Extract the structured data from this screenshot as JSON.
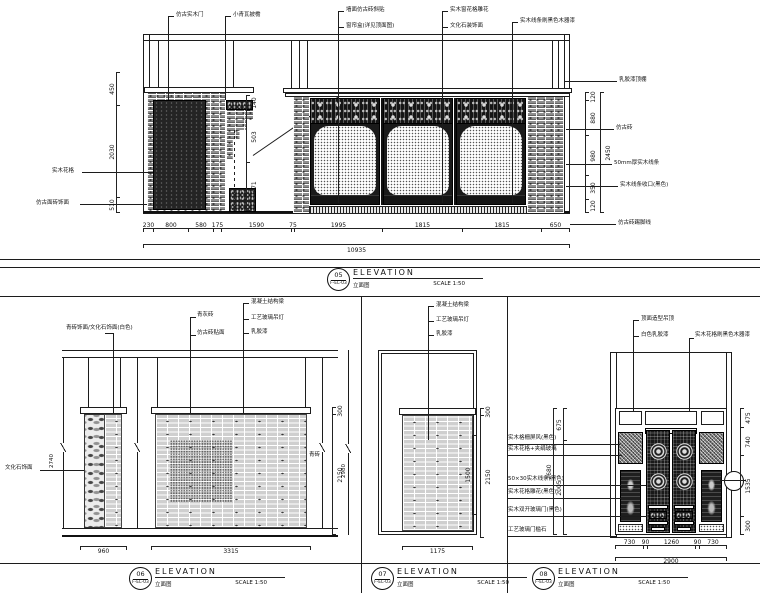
{
  "colors": {
    "paper": "#ffffff",
    "line": "#1c1c1c"
  },
  "titles": {
    "d05": {
      "num": "05",
      "ref": "F-EL-03",
      "elev": "ELEVATION",
      "cn": "立面图",
      "scale": "SCALE  1:50"
    },
    "d06": {
      "num": "06",
      "ref": "F-EL-03",
      "elev": "ELEVATION",
      "cn": "立面图",
      "scale": "SCALE  1:50"
    },
    "d07": {
      "num": "07",
      "ref": "F-EL-03",
      "elev": "ELEVATION",
      "cn": "立面图",
      "scale": "SCALE  1:50"
    },
    "d08": {
      "num": "08",
      "ref": "F-EL-03",
      "elev": "ELEVATION",
      "cn": "立面图",
      "scale": "SCALE  1:50"
    }
  },
  "d05": {
    "callouts": {
      "t1": "仿古实木门",
      "t2": "小青瓦披檐",
      "t3": "墙面仿古砖斜贴",
      "t4": "窗帘盒(详见顶面图)",
      "t5": "实木窗花格雕花",
      "t6": "文化石装饰面",
      "t7": "实木线条刷黑色木器漆",
      "r1": "乳胶漆顶棚",
      "r2": "仿古砖",
      "r3": "50mm厚实木线条",
      "r4": "实木线条收口(黑色)",
      "r5": "仿古砖踢脚线",
      "l1": "实木花格",
      "l2": "仿古面砖饰面"
    },
    "dims_bottom": [
      "230",
      "800",
      "580",
      "175",
      "1590",
      "75",
      "1995",
      "1815",
      "1815",
      "650"
    ],
    "dims_bottom_total": "10935",
    "dims_left": [
      "450",
      "2030",
      "510"
    ],
    "dims_mid": [
      "140",
      "503",
      "471"
    ],
    "dims_right": [
      "120",
      "880",
      "980",
      "350",
      "120"
    ],
    "dims_right_total": "2450"
  },
  "d06": {
    "callouts": {
      "c1": "青砖饰面/文化石饰面(白色)",
      "c2": "青灰砖",
      "c3": "仿古砖贴面",
      "c4": "混凝土结构梁",
      "c5": "工艺玻璃吊灯",
      "c6": "乳胶漆",
      "left": "文化石饰面",
      "right": "青砖"
    },
    "dims": {
      "col_w": "960",
      "wall_w": "3315",
      "cap_h": "300",
      "wall_h": "2150",
      "total_h": "2740"
    }
  },
  "d07": {
    "callouts": {
      "c1": "混凝土结构梁",
      "c2": "工艺玻璃吊灯",
      "c3": "乳胶漆"
    },
    "dims": {
      "wall_w": "1175",
      "cap_h": "300",
      "wall_h": "2150",
      "inner_h": "1500",
      "total_h": "2980"
    }
  },
  "d08": {
    "callouts": {
      "t1": "顶面造型吊顶",
      "t2": "白色乳胶漆",
      "t3": "实木花格刷黑色木器漆",
      "l1": "实木格栅屏风(黑色)",
      "l2": "实木花格+夹绢玻璃",
      "l3": "50×30实木线条(黑色)",
      "l4": "实木花格雕花(黑色)",
      "l5": "实木双开玻璃门(黑色)",
      "l6": "工艺玻璃门槛石"
    },
    "dims": {
      "left": [
        "675",
        "2005"
      ],
      "left_total": "2680",
      "right": [
        "475",
        "740",
        "1535",
        "300"
      ],
      "bottom": [
        "730",
        "90",
        "1260",
        "90",
        "730"
      ],
      "bottom_total": "2900"
    }
  }
}
